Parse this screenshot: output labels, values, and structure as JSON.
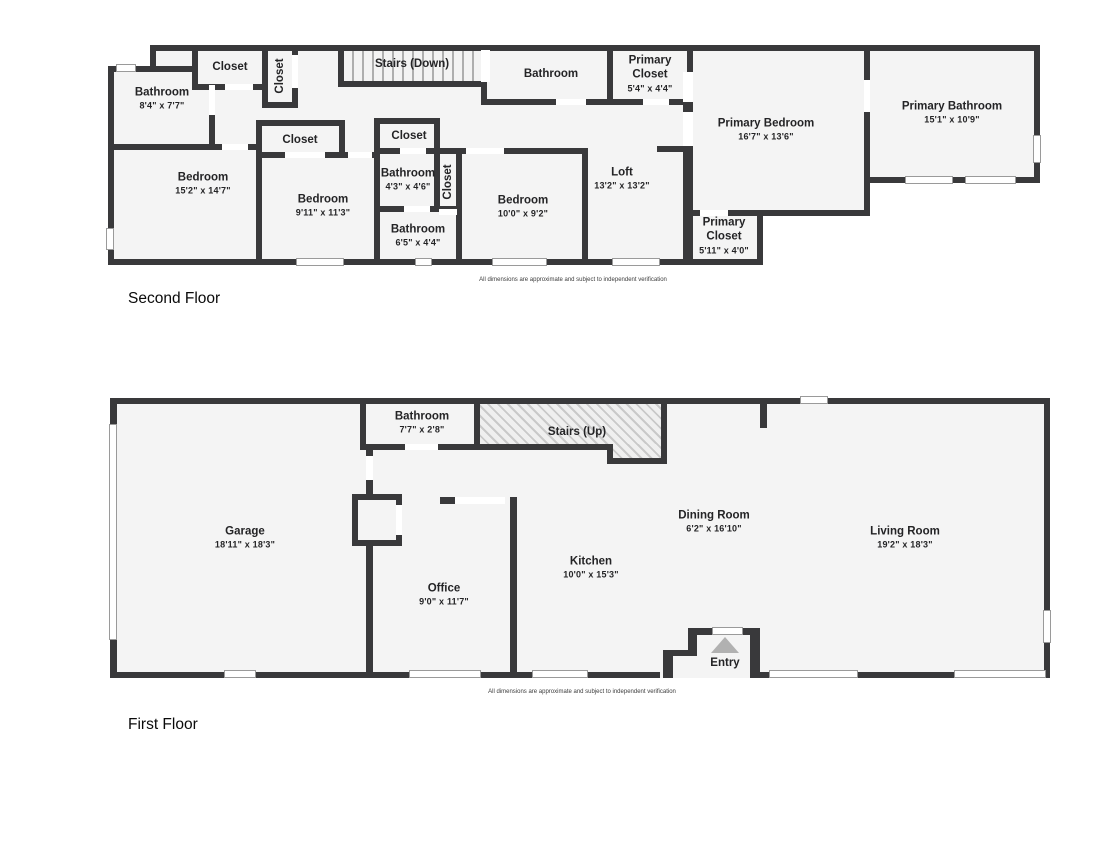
{
  "colors": {
    "wall": "#39393b",
    "floor_fill": "#f4f4f4",
    "background": "#ffffff",
    "entry_arrow": "#b1b1b1"
  },
  "floors": {
    "second": {
      "title": "Second Floor",
      "disclaimer": "All dimensions are approximate and subject to independent verification",
      "rooms": {
        "bathroom_a": {
          "name": "Bathroom",
          "dims": "8'4\" x 7'7\""
        },
        "closet_a": {
          "name": "Closet"
        },
        "closet_b": {
          "name": "Closet"
        },
        "stairs": {
          "name": "Stairs (Down)"
        },
        "bathroom_b": {
          "name": "Bathroom"
        },
        "primary_closet_a": {
          "name": "Primary Closet",
          "dims": "5'4\" x 4'4\""
        },
        "primary_bedroom": {
          "name": "Primary Bedroom",
          "dims": "16'7\" x 13'6\""
        },
        "primary_bathroom": {
          "name": "Primary Bathroom",
          "dims": "15'1\" x 10'9\""
        },
        "bedroom_a": {
          "name": "Bedroom",
          "dims": "15'2\" x 14'7\""
        },
        "closet_c": {
          "name": "Closet"
        },
        "bedroom_b": {
          "name": "Bedroom",
          "dims": "9'11\" x 11'3\""
        },
        "closet_d": {
          "name": "Closet"
        },
        "bathroom_c": {
          "name": "Bathroom",
          "dims": "4'3\" x 4'6\""
        },
        "closet_e": {
          "name": "Closet"
        },
        "bathroom_d": {
          "name": "Bathroom",
          "dims": "6'5\" x 4'4\""
        },
        "bedroom_c": {
          "name": "Bedroom",
          "dims": "10'0\" x 9'2\""
        },
        "loft": {
          "name": "Loft",
          "dims": "13'2\" x 13'2\""
        },
        "primary_closet_b": {
          "name": "Primary Closet",
          "dims": "5'11\" x 4'0\""
        }
      }
    },
    "first": {
      "title": "First Floor",
      "disclaimer": "All dimensions are approximate and subject to independent verification",
      "rooms": {
        "bathroom": {
          "name": "Bathroom",
          "dims": "7'7\" x 2'8\""
        },
        "stairs": {
          "name": "Stairs (Up)"
        },
        "garage": {
          "name": "Garage",
          "dims": "18'11\" x 18'3\""
        },
        "office": {
          "name": "Office",
          "dims": "9'0\" x 11'7\""
        },
        "kitchen": {
          "name": "Kitchen",
          "dims": "10'0\" x 15'3\""
        },
        "dining_room": {
          "name": "Dining Room",
          "dims": "6'2\" x 16'10\""
        },
        "living_room": {
          "name": "Living Room",
          "dims": "19'2\" x 18'3\""
        },
        "entry": {
          "name": "Entry"
        }
      }
    }
  }
}
